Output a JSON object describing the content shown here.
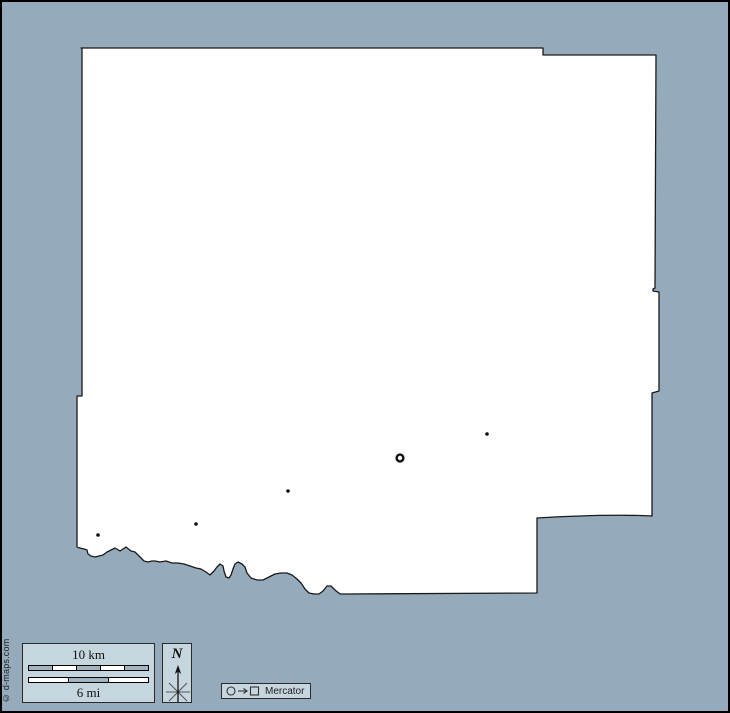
{
  "frame": {
    "background_color": "#95ABBB",
    "border_color": "#000000"
  },
  "map": {
    "fill_color": "#FFFFFF",
    "outline_color": "#1A1A1A",
    "outline_path": "M81,48 H543 V55 H656 L655,288 L653,289 L653,291 L659,292 V391 L652,393 V516 C612,514 570,516 537,518 V593 L345,594 L340,594 L335,590 L331,586 L327,586 L323,591 L319,594 L314,594 L309,593 L305,589 L301,583 L297,579 L292,575 L287,573 L281,573 L275,574 L269,577 L263,580 L257,580 L251,578 L247,573 L245,567 L242,564 L238,562 L235,564 L233,569 L231,575 L229,578 L226,577 L224,571 L223,566 L220,564 L217,567 L214,571 L210,575 L206,572 L201,569 L196,568 L190,566 L184,564 L178,563 L172,563 L166,561 L160,562 L155,561 L152,561 L148,562 L144,561 L141,558 L138,555 L135,552 L131,551 L126,547 L120,551 L115,548 L111,550 L107,552 L103,555 L99,556 L95,557 L91,556 L88,554 L87,550 L84,549 L80,548 L77,547 L77,396 L82,396 L82,48 Z",
    "markers": [
      {
        "type": "dot",
        "x": 98,
        "y": 535
      },
      {
        "type": "dot",
        "x": 196,
        "y": 524
      },
      {
        "type": "dot",
        "x": 288,
        "y": 491
      },
      {
        "type": "ring",
        "x": 400,
        "y": 458
      },
      {
        "type": "dot",
        "x": 487,
        "y": 434
      }
    ]
  },
  "legend": {
    "box_fill": "#C6D6DF",
    "box_border": "#2A2A2A",
    "scale": {
      "km_label": "10 km",
      "mi_label": "6 mi",
      "km_segments": [
        "gray",
        "white",
        "gray",
        "white",
        "gray"
      ],
      "mi_segments": [
        "white",
        "gray",
        "white"
      ],
      "segment_gray": "#A0B4BF",
      "segment_white": "#FFFFFF"
    },
    "compass": {
      "north_label": "N"
    },
    "projection": {
      "label": "Mercator"
    }
  },
  "copyright": "© d-maps.com"
}
